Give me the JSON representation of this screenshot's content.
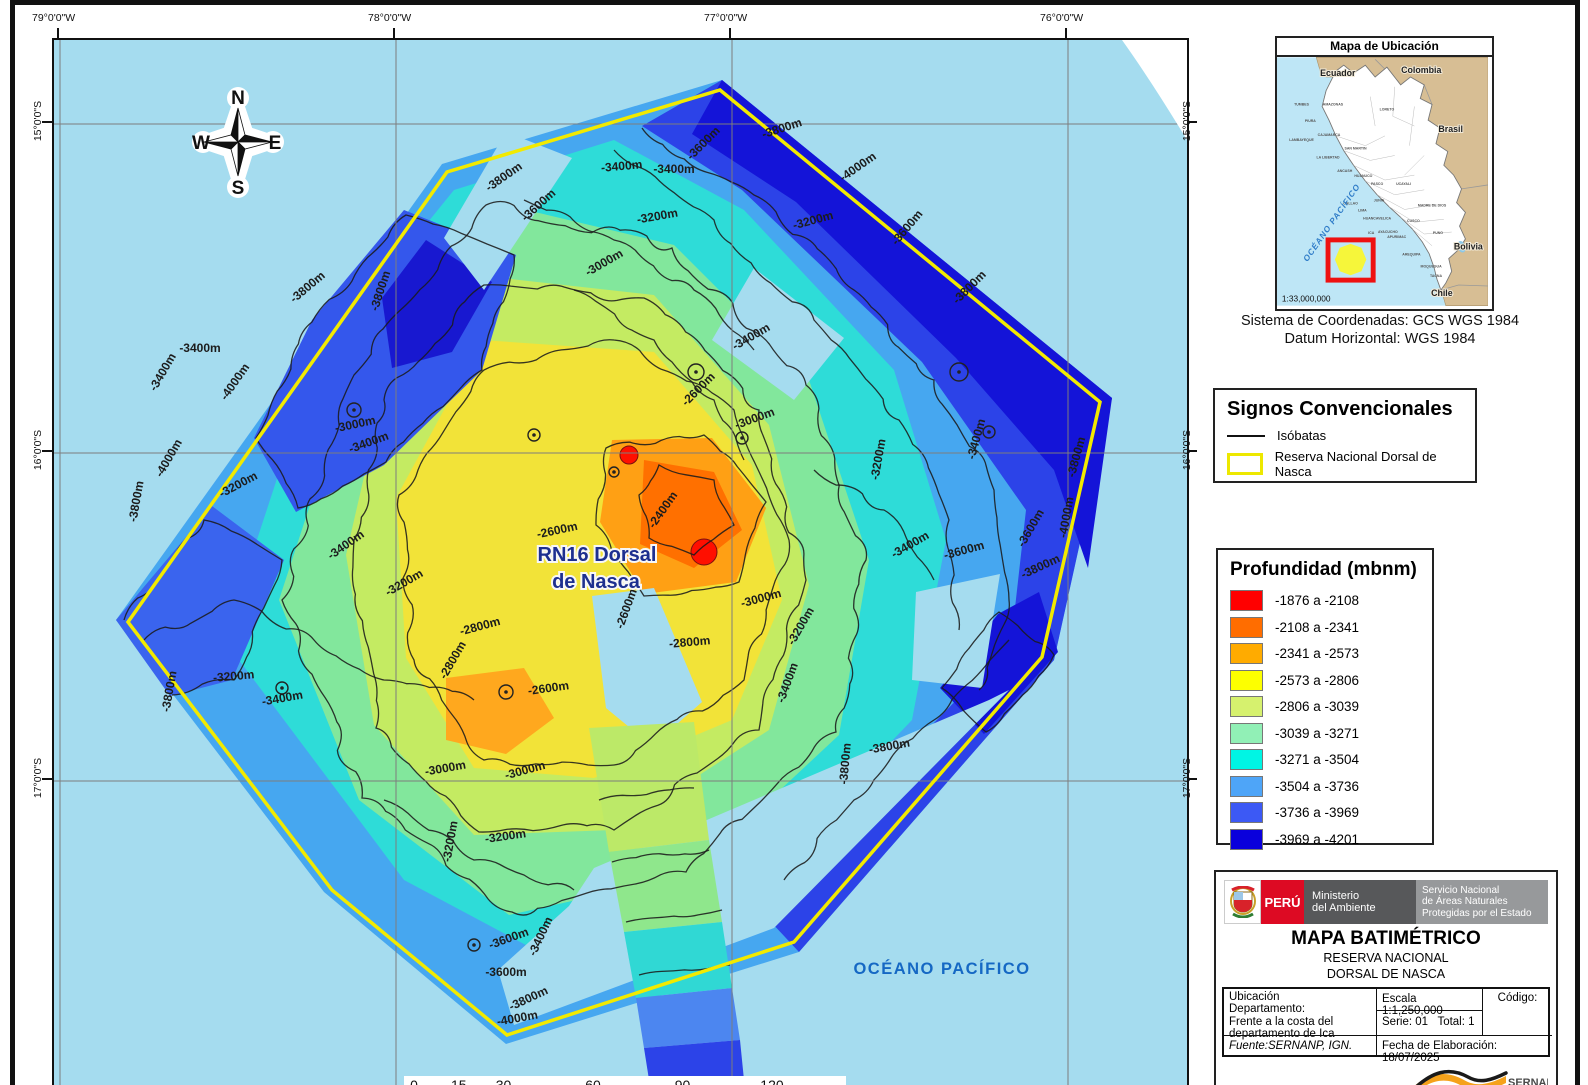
{
  "map": {
    "ocean_color": "#A5DCEF",
    "boundary_color": "#F2EA00",
    "grid": {
      "top": [
        {
          "t": "79°0'0\"W",
          "x": 58
        },
        {
          "t": "78°0'0\"W",
          "x": 394
        },
        {
          "t": "77°0'0\"W",
          "x": 730
        },
        {
          "t": "76°0'0\"W",
          "x": 1066
        }
      ],
      "left": [
        {
          "t": "15°0'0\"S",
          "y": 122
        },
        {
          "t": "16°0'0\"S",
          "y": 451
        },
        {
          "t": "17°0'0\"S",
          "y": 779
        }
      ],
      "right": [
        {
          "t": "15°0'0\"S",
          "y": 122
        },
        {
          "t": "16°0'0\"S",
          "y": 451
        },
        {
          "t": "17°0'0\"S",
          "y": 779
        }
      ],
      "gridx": [
        6,
        342,
        678,
        1014
      ],
      "gridy": [
        84,
        413,
        741
      ]
    },
    "compass": {
      "n": "N",
      "s": "S",
      "e": "E",
      "w": "W"
    },
    "reserve_label": [
      "RN16 Dorsal",
      "de Nasca"
    ],
    "ocean_label": "OCÉANO PACÍFICO",
    "scalebar": {
      "ticks": [
        {
          "km": 0,
          "t": "0"
        },
        {
          "km": 15,
          "t": "15"
        },
        {
          "km": 30,
          "t": "30"
        },
        {
          "km": 60,
          "t": "60"
        },
        {
          "km": 90,
          "t": "90"
        },
        {
          "km": 120,
          "t": "120"
        }
      ],
      "unit": "Kilómetros",
      "segments": [
        [
          0,
          7.5,
          "b"
        ],
        [
          7.5,
          15,
          "w"
        ],
        [
          15,
          22.5,
          "b"
        ],
        [
          22.5,
          30,
          "w"
        ],
        [
          30,
          60,
          "b"
        ],
        [
          60,
          90,
          "w"
        ],
        [
          90,
          120,
          "b"
        ]
      ]
    },
    "boundary": "666,50 1046,362 988,617 740,902 453,995 278,850 74,582 393,132",
    "zones": [
      {
        "n": "data-base",
        "c": "#46A7F0",
        "p": "668,40 1058,358 1000,620 745,912 452,1004 270,852 62,580 388,124"
      },
      {
        "n": "zone-cyan",
        "c": "#2EDCD8",
        "p": "560,100 690,170 840,330 892,500 858,680 700,845 500,920 350,840 170,600 262,320 400,150"
      },
      {
        "n": "zone-green",
        "c": "#82E79C",
        "p": "430,160 620,205 755,340 815,520 785,695 635,835 455,875 305,760 225,560 300,330"
      },
      {
        "n": "zone-yellowgreen",
        "c": "#C4EB62",
        "p": "420,235 600,255 715,385 755,545 715,690 560,790 420,795 320,685 292,515 330,350"
      },
      {
        "n": "zone-yellow",
        "c": "#F2E338",
        "p": "428,300 600,312 698,425 728,560 678,680 540,738 420,728 352,618 342,458"
      },
      {
        "n": "zone-blue-ne",
        "c": "#2C43E8",
        "p": "668,40 1058,358 1000,620 952,648 972,470 868,322 688,150 588,86"
      },
      {
        "n": "zone-darkblue-ne",
        "c": "#1414D8",
        "p": "668,40 1058,358 1034,528 1000,430 902,318 742,162 638,94"
      },
      {
        "n": "zone-blue-se",
        "c": "#2C43E8",
        "p": "1000,620 745,912 702,866 820,745 912,650 956,600"
      },
      {
        "n": "zone-darkblue-e",
        "c": "#1414D8",
        "p": "985,552 1004,612 930,694 886,648 944,574"
      },
      {
        "n": "zone-blue-nw",
        "c": "#3457EC",
        "p": "350,170 462,215 428,330 330,425 242,472 200,398 258,280"
      },
      {
        "n": "zone-darkblue-nw",
        "c": "#1818D0",
        "p": "372,200 438,242 398,312 338,328 328,258"
      },
      {
        "n": "zone-blue-w",
        "c": "#3A64EE",
        "p": "62,580 158,466 230,520 178,640 116,656"
      },
      {
        "n": "zone-orange",
        "c": "#FFA014",
        "p": "558,400 658,398 712,468 682,542 590,554 546,482"
      },
      {
        "n": "zone-orange-deep",
        "c": "#FF7000",
        "p": "590,420 660,432 688,490 640,528 586,504"
      },
      {
        "n": "zone-orange-s",
        "c": "#FFA81E",
        "p": "392,638 470,628 500,678 452,714 392,700"
      },
      {
        "n": "zone-red",
        "c": "#FF0F00",
        "circle": [
          575,
          415,
          9
        ]
      },
      {
        "n": "zone-red",
        "c": "#FF0F00",
        "circle": [
          650,
          512,
          13
        ]
      },
      {
        "n": "nodata-gap",
        "c": "#A5DCEF",
        "p": "538,556 600,548 648,662 598,706 552,668"
      },
      {
        "n": "nodata-gap",
        "c": "#A5DCEF",
        "p": "452,92 518,118 430,250 390,198"
      },
      {
        "n": "nodata-gap",
        "c": "#A5DCEF",
        "p": "862,552 946,534 928,648 858,640"
      },
      {
        "n": "nodata-gap",
        "c": "#A5DCEF",
        "p": "700,228 790,298 740,360 658,300"
      },
      {
        "n": "nodata-gap",
        "c": "#A5DCEF",
        "p": "540,828 935,660 955,650 720,888 460,985 444,930 515,866"
      },
      {
        "n": "survey-strip",
        "c": "#BCE968",
        "p": "535,688 640,682 655,800 555,812"
      },
      {
        "n": "survey-strip",
        "c": "#8FE78C",
        "p": "555,812 655,800 668,882 570,892"
      },
      {
        "n": "survey-strip",
        "c": "#30D8D4",
        "p": "570,892 668,882 678,948 582,958"
      },
      {
        "n": "survey-strip",
        "c": "#4C86F0",
        "p": "582,958 678,948 686,1000 590,1008"
      },
      {
        "n": "survey-strip",
        "c": "#2C43E8",
        "p": "590,1008 686,1000 690,1040 596,1046"
      }
    ],
    "contour_lines": [
      {
        "closed": true,
        "amp": 4,
        "pts": [
          345,
          455,
          430,
          330,
          560,
          300,
          680,
          370,
          735,
          500,
          690,
          640,
          560,
          725,
          430,
          720,
          360,
          620
        ]
      },
      {
        "closed": true,
        "amp": 5,
        "pts": [
          300,
          500,
          330,
          360,
          430,
          245,
          590,
          258,
          705,
          370,
          752,
          540,
          705,
          690,
          560,
          790,
          425,
          792,
          322,
          688
        ]
      },
      {
        "closed": true,
        "amp": 6,
        "pts": [
          228,
          560,
          300,
          335,
          432,
          165,
          618,
          208,
          752,
          345,
          812,
          520,
          782,
          692,
          632,
          832,
          458,
          872,
          308,
          758
        ]
      },
      {
        "closed": false,
        "amp": 5,
        "pts": [
          588,
          88,
          700,
          155,
          800,
          250,
          880,
          340,
          940,
          450,
          955,
          560,
          925,
          650
        ]
      },
      {
        "closed": false,
        "amp": 5,
        "pts": [
          560,
          110,
          660,
          180,
          760,
          280,
          845,
          380,
          895,
          480,
          905,
          590
        ]
      },
      {
        "closed": true,
        "amp": 4,
        "pts": [
          352,
          175,
          460,
          215,
          428,
          330,
          332,
          422,
          244,
          468,
          202,
          398,
          258,
          282
        ]
      },
      {
        "closed": false,
        "amp": 4,
        "pts": [
          70,
          580,
          150,
          480,
          228,
          520,
          180,
          640,
          118,
          655
        ]
      },
      {
        "closed": false,
        "amp": 3,
        "pts": [
          545,
          760,
          640,
          748
        ]
      },
      {
        "closed": false,
        "amp": 3,
        "pts": [
          558,
          822,
          655,
          810
        ]
      },
      {
        "closed": false,
        "amp": 3,
        "pts": [
          572,
          882,
          668,
          870
        ]
      },
      {
        "closed": false,
        "amp": 3,
        "pts": [
          585,
          935,
          676,
          925
        ]
      },
      {
        "closed": false,
        "amp": 4,
        "pts": [
          955,
          600,
          880,
          680,
          800,
          760,
          730,
          840
        ]
      },
      {
        "closed": false,
        "amp": 4,
        "pts": [
          330,
          760,
          420,
          820,
          520,
          850
        ]
      },
      {
        "closed": true,
        "amp": 3,
        "pts": [
          552,
          408,
          650,
          395,
          712,
          462,
          685,
          542,
          590,
          556,
          542,
          485
        ]
      },
      {
        "closed": true,
        "amp": 3,
        "pts": [
          945,
          572,
          1000,
          615,
          932,
          692,
          888,
          648
        ]
      },
      {
        "closed": false,
        "amp": 4,
        "pts": [
          470,
          160,
          560,
          200,
          640,
          250,
          700,
          310
        ]
      },
      {
        "closed": false,
        "amp": 4,
        "pts": [
          520,
          250,
          600,
          300,
          660,
          360,
          690,
          420
        ]
      },
      {
        "closed": false,
        "amp": 4,
        "pts": [
          90,
          600,
          180,
          560,
          260,
          600,
          330,
          640,
          420,
          660
        ]
      },
      {
        "closed": false,
        "amp": 4,
        "pts": [
          760,
          430,
          830,
          470,
          880,
          540
        ]
      },
      {
        "closed": true,
        "amp": 3,
        "pts": [
          605,
          425,
          660,
          440,
          680,
          485,
          640,
          515,
          595,
          498,
          585,
          455
        ]
      }
    ],
    "seamounts": [
      [
        300,
        370,
        7
      ],
      [
        480,
        395,
        6
      ],
      [
        642,
        332,
        8
      ],
      [
        905,
        332,
        9
      ],
      [
        935,
        392,
        6
      ],
      [
        452,
        652,
        7
      ],
      [
        560,
        432,
        5
      ],
      [
        228,
        648,
        6
      ],
      [
        420,
        905,
        6
      ],
      [
        688,
        398,
        6
      ]
    ],
    "contour_labels": [
      [
        "-3800m",
        452,
        140,
        -35
      ],
      [
        "-3600m",
        487,
        168,
        -42
      ],
      [
        "-3400m",
        568,
        130,
        -5
      ],
      [
        "-3800m",
        729,
        92,
        -18
      ],
      [
        "-3600m",
        652,
        106,
        -45
      ],
      [
        "-3400m",
        620,
        133,
        0
      ],
      [
        "-3200m",
        760,
        184,
        -15
      ],
      [
        "-4000m",
        806,
        130,
        -35
      ],
      [
        "-3600m",
        856,
        190,
        -50
      ],
      [
        "-3200m",
        604,
        180,
        -10
      ],
      [
        "-3000m",
        552,
        226,
        -30
      ],
      [
        "-3800m",
        256,
        250,
        -40
      ],
      [
        "-3800m",
        330,
        252,
        -72
      ],
      [
        "-4000m",
        184,
        344,
        -55
      ],
      [
        "-4000m",
        118,
        420,
        -60
      ],
      [
        "-3800m",
        86,
        462,
        -80
      ],
      [
        "-3400m",
        146,
        312,
        0
      ],
      [
        "-3400m",
        112,
        334,
        -60
      ],
      [
        "-3000m",
        302,
        388,
        -12
      ],
      [
        "-3200m",
        186,
        448,
        -28
      ],
      [
        "-3400m",
        294,
        508,
        -35
      ],
      [
        "-3400m",
        316,
        406,
        -20
      ],
      [
        "-3200m",
        352,
        546,
        -30
      ],
      [
        "-2600m",
        504,
        494,
        -12
      ],
      [
        "-2600m",
        576,
        570,
        -70
      ],
      [
        "-2800m",
        636,
        606,
        -5
      ],
      [
        "-3000m",
        708,
        562,
        -15
      ],
      [
        "-3200m",
        750,
        588,
        -60
      ],
      [
        "-2400m",
        612,
        472,
        -55
      ],
      [
        "-3600m",
        980,
        490,
        -60
      ],
      [
        "-4000m",
        1016,
        478,
        -80
      ],
      [
        "-3800m",
        1026,
        418,
        -75
      ],
      [
        "-3400m",
        926,
        400,
        -75
      ],
      [
        "-3400m",
        858,
        508,
        -30
      ],
      [
        "-3600m",
        911,
        514,
        -15
      ],
      [
        "-3800m",
        988,
        530,
        -25
      ],
      [
        "-3200m",
        828,
        420,
        -80
      ],
      [
        "-3800m",
        918,
        250,
        -45
      ],
      [
        "-3200m",
        452,
        800,
        -8
      ],
      [
        "-3200m",
        400,
        802,
        -80
      ],
      [
        "-3400m",
        490,
        898,
        -65
      ],
      [
        "-3600m",
        456,
        902,
        -20
      ],
      [
        "-3600m",
        452,
        936,
        0
      ],
      [
        "-3800m",
        476,
        962,
        -25
      ],
      [
        "-4000m",
        464,
        982,
        -10
      ],
      [
        "-3000m",
        392,
        732,
        -10
      ],
      [
        "-3000m",
        472,
        734,
        -15
      ],
      [
        "-2800m",
        427,
        590,
        -15
      ],
      [
        "-2800m",
        402,
        622,
        -60
      ],
      [
        "-2600m",
        495,
        652,
        -8
      ],
      [
        "-3200m",
        180,
        640,
        -5
      ],
      [
        "-3800m",
        119,
        652,
        -80
      ],
      [
        "-3400m",
        229,
        662,
        -10
      ],
      [
        "-3400m",
        737,
        644,
        -70
      ],
      [
        "-3800m",
        795,
        724,
        -85
      ],
      [
        "-3800m",
        836,
        710,
        -10
      ],
      [
        "-3000m",
        702,
        382,
        -20
      ],
      [
        "-2600m",
        647,
        352,
        -45
      ],
      [
        "-3400m",
        699,
        300,
        -30
      ]
    ]
  },
  "inset": {
    "title": "Mapa de Ubicación",
    "scale": "1:33,000,000",
    "ocean_label": "OCÉANO PACÍFICO",
    "countries": [
      [
        "Ecuador",
        62,
        19
      ],
      [
        "Colombia",
        147,
        16
      ],
      [
        "Brasil",
        177,
        76
      ],
      [
        "Bolivia",
        195,
        196
      ],
      [
        "Chile",
        168,
        243
      ]
    ],
    "departments": [
      [
        "TUMBES",
        25,
        49
      ],
      [
        "AMAZONAS",
        57,
        49
      ],
      [
        "LORETO",
        112,
        54
      ],
      [
        "PIURA",
        34,
        66
      ],
      [
        "LAMBAYEQUE",
        25,
        85
      ],
      [
        "CAJAMARCA",
        53,
        80
      ],
      [
        "SAN MARTIN",
        80,
        94
      ],
      [
        "LA LIBERTAD",
        52,
        103
      ],
      [
        "ANCASH",
        69,
        117
      ],
      [
        "HUANUCO",
        88,
        122
      ],
      [
        "PASCO",
        102,
        130
      ],
      [
        "UCAYALI",
        129,
        130
      ],
      [
        "JUNIN",
        104,
        147
      ],
      [
        "CALLAO",
        75,
        150
      ],
      [
        "LIMA",
        87,
        157
      ],
      [
        "HUANCAVELICA",
        102,
        165
      ],
      [
        "CUSCO",
        139,
        168
      ],
      [
        "MADRE DE DIOS",
        158,
        152
      ],
      [
        "ICA",
        96,
        180
      ],
      [
        "AYACUCHO",
        113,
        179
      ],
      [
        "APURIMAC",
        122,
        184
      ],
      [
        "PUNO",
        164,
        180
      ],
      [
        "AREQUIPA",
        137,
        202
      ],
      [
        "MOQUEGUA",
        157,
        214
      ],
      [
        "TACNA",
        162,
        224
      ]
    ]
  },
  "crs": {
    "line1": "Sistema de Coordenadas: GCS WGS 1984",
    "line2": "Datum Horizontal: WGS 1984"
  },
  "legend_symbols": {
    "title": "Signos Convencionales",
    "items": [
      {
        "label": "Isóbatas",
        "type": "line"
      },
      {
        "label": "Reserva Nacional Dorsal de Nasca",
        "type": "rect",
        "color": "#EDE800"
      }
    ]
  },
  "legend_depth": {
    "title": "Profundidad (mbnm)",
    "classes": [
      {
        "range": "-1876 a -2108",
        "color": "#FF0000"
      },
      {
        "range": "-2108 a -2341",
        "color": "#FF6D00"
      },
      {
        "range": "-2341 a -2573",
        "color": "#FFAB00"
      },
      {
        "range": "-2573 a -2806",
        "color": "#FDFF00"
      },
      {
        "range": "-2806 a -3039",
        "color": "#D6F16E"
      },
      {
        "range": "-3039 a -3271",
        "color": "#91F0B6"
      },
      {
        "range": "-3271 a -3504",
        "color": "#00F5E4"
      },
      {
        "range": "-3504 a -3736",
        "color": "#4EA5F8"
      },
      {
        "range": "-3736 a -3969",
        "color": "#3C59F5"
      },
      {
        "range": "-3969 a -4201",
        "color": "#0A00DC"
      }
    ]
  },
  "title_block": {
    "country": "PERÚ",
    "ministry_line1": "Ministerio",
    "ministry_line2": "del Ambiente",
    "service_line1": "Servicio Nacional",
    "service_line2": "de Áreas Naturales",
    "service_line3": "Protegidas por el Estado",
    "title": "MAPA BATIMÉTRICO",
    "subtitle1": "RESERVA NACIONAL",
    "subtitle2": "DORSAL DE NASCA",
    "loc_line1": "Ubicación",
    "loc_line2": "Departamento:",
    "loc_value": "Frente a la costa del departamento de Ica",
    "escala_label": "Escala",
    "escala_value": "1:1,250,000",
    "serie_label": "Serie:",
    "serie_value": "01",
    "total_label": "Total:",
    "total_value": "1",
    "codigo_label": "Código:",
    "fuente": "Fuente:SERNANP, IGN.",
    "fecha": "Fecha de Elaboración: 18/07/2025",
    "logo_text": "SERNANP",
    "logo_sub": "PERÚ"
  }
}
